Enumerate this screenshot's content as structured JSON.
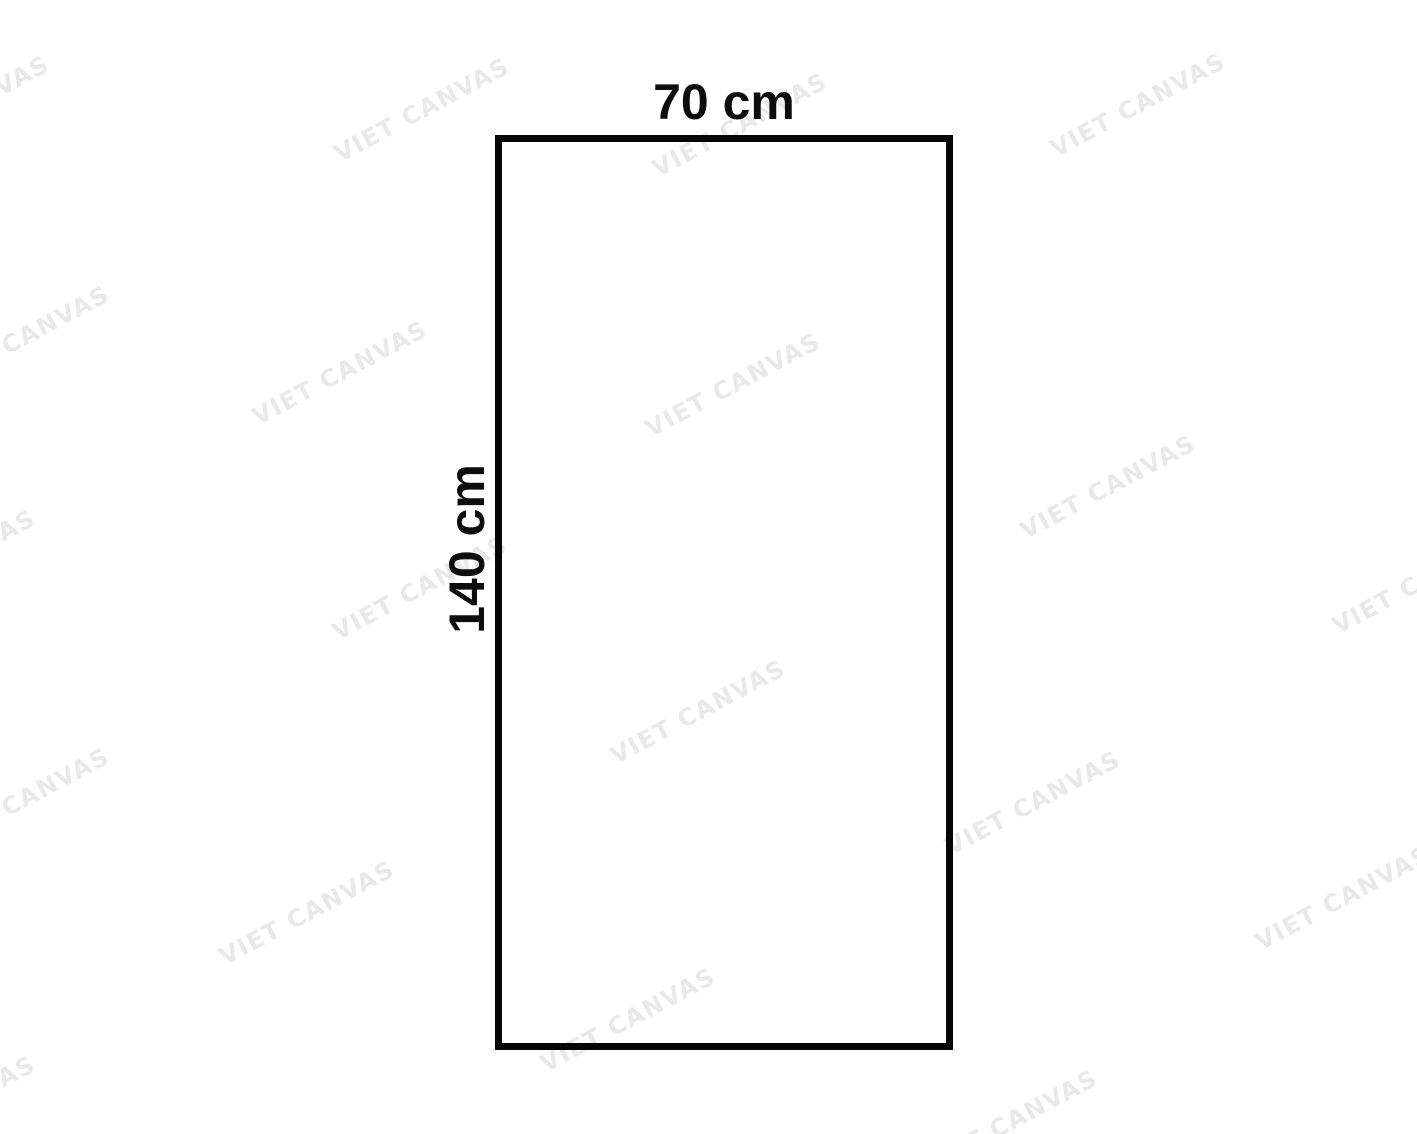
{
  "diagram": {
    "width_label": "70 cm",
    "height_label": "140 cm",
    "border_color": "#060606",
    "label_color": "#0d0d0d"
  },
  "watermark": {
    "text": "VIET CANVAS",
    "color": "#e9e9e9"
  }
}
